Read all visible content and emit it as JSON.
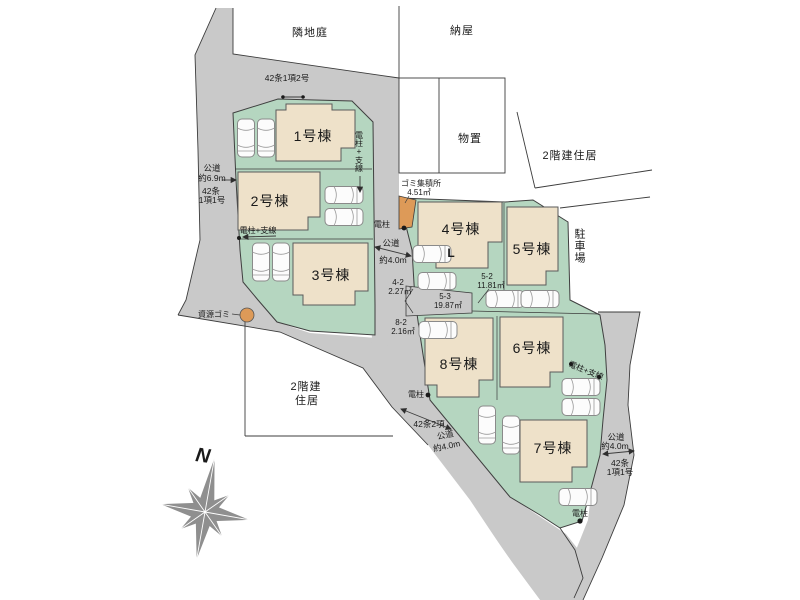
{
  "areas": {
    "neighbor_garden": "隣地庭",
    "barn": "納屋",
    "storage": "物置",
    "house_right": "2階建住居",
    "house_left_l1": "2階建",
    "house_left_l2": "住居",
    "parking_lot": "駐車場"
  },
  "buildings": [
    {
      "label": "1号棟"
    },
    {
      "label": "2号棟"
    },
    {
      "label": "3号棟"
    },
    {
      "label": "4号棟"
    },
    {
      "label": "5号棟"
    },
    {
      "label": "6号棟"
    },
    {
      "label": "7号棟"
    },
    {
      "label": "8号棟"
    }
  ],
  "roads": {
    "top_class": "42条1項2号",
    "left_w1": "公道",
    "left_w2": "約6.9m",
    "left_c1": "42条",
    "left_c2": "1項1号",
    "center_w1": "公道",
    "center_w2": "約4.0m",
    "bottom_class": "42条2項",
    "bottom_w1": "公道",
    "bottom_w2": "約4.0m",
    "right_w1": "公道",
    "right_w2": "約4.0m",
    "right_c1": "42条",
    "right_c2": "1項1号"
  },
  "utilities": {
    "pole": "電柱",
    "pole_wire": "電柱+支線"
  },
  "waste": {
    "station_l1": "ゴミ集積所",
    "station_l2": "4.51㎡",
    "recycle": "資源ゴミ"
  },
  "parcels": {
    "p42_id": "4-2",
    "p42_area": "2.27㎡",
    "p52_id": "5-2",
    "p52_area": "11.81㎡",
    "p53_id": "5-3",
    "p53_area": "19.87㎡",
    "p82_id": "8-2",
    "p82_area": "2.16㎡"
  },
  "compass": {
    "north": "N"
  },
  "misc": {
    "l_mark": "L"
  },
  "colors": {
    "road": "#c9c9c9",
    "lot_green": "#b5d6c0",
    "building": "#eee1c9",
    "orange": "#dd9a58",
    "compass_gray": "#8f8f8f"
  }
}
